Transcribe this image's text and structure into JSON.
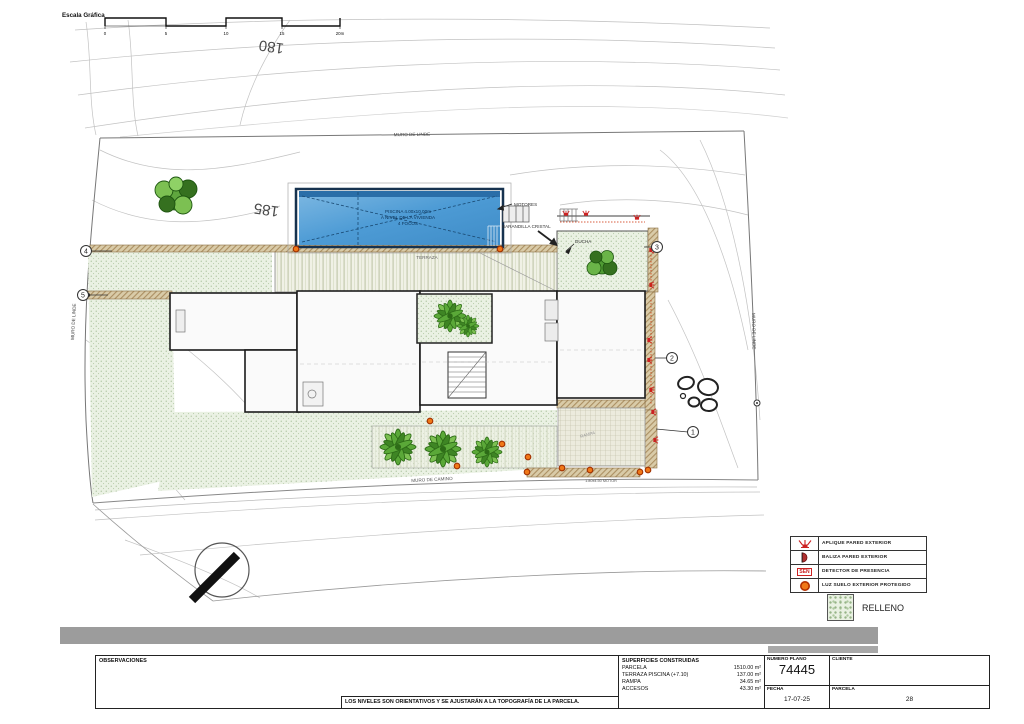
{
  "drawing": {
    "scale": {
      "title": "Escala Gráfica",
      "ticks": [
        "0",
        "5",
        "10",
        "15",
        "20m"
      ]
    },
    "contours": {
      "c180": "180",
      "c185": "185",
      "c190": "190"
    },
    "labels": {
      "muro_linde_top": "MURO DE LINDE",
      "muro_linde_left": "MURO DE LINDE",
      "muro_linde_right": "MURO DE LINDE",
      "muro_camino": "MURO DE CAMINO",
      "terraza": "TERRAZA",
      "ducha": "DUCHA",
      "motores": "MOTORES",
      "barandilla_cristal": "BARANDILLA CRISTAL",
      "rampa": "RAMPA",
      "motor_gate": "1.80x4.50 MOTOR",
      "pool_line1": "PISCINA 4.00x10.00m",
      "pool_line2": "A NIVEL DE LA VIVIENDA",
      "pool_line3": "4 FOCOS"
    },
    "markers": {
      "m1": "1",
      "m2": "2",
      "m3": "3",
      "m4": "4",
      "m5": "5"
    }
  },
  "legend": {
    "items": [
      {
        "symbol": "wall-sconce",
        "label": "APLIQUE PARED EXTERIOR"
      },
      {
        "symbol": "half-dome",
        "label": "BALIZA PARED EXTERIOR"
      },
      {
        "symbol": "sen-box",
        "sen_text": "SEN",
        "label": "DETECTOR DE PRESENCIA"
      },
      {
        "symbol": "ground-light",
        "label": "LUZ SUELO EXTERIOR PROTEGIDO"
      }
    ],
    "relleno": "RELLENO"
  },
  "titleblock": {
    "observaciones": "OBSERVACIONES",
    "note": "LOS NIVELES SON ORIENTATIVOS Y SE AJUSTARÁN A LA TOPOGRAFÍA DE LA PARCELA.",
    "superficies": {
      "header": "SUPERFICIES CONSTRUIDAS",
      "rows": [
        {
          "name": "PARCELA",
          "value": "1510.00 m²"
        },
        {
          "name": "TERRAZA PISCINA (+7.10)",
          "value": "137.00 m²"
        },
        {
          "name": "RAMPA",
          "value": "34.65 m²"
        },
        {
          "name": "ACCESOS",
          "value": "43.30 m²"
        }
      ]
    },
    "numero_plano_label": "NUMERO PLANO",
    "numero_plano": "74445",
    "fecha_label": "FECHA",
    "fecha": "17-07-25",
    "cliente_label": "CLIENTE",
    "parcela_label": "PARCELA",
    "parcela": "28"
  },
  "colors": {
    "pool_water": "#4d9bd5",
    "pool_border": "#16324f",
    "relleno_fill": "#e9f1e2",
    "wall_tan": "#d9cba8",
    "accent_red": "#cc2a00",
    "ground_light_orange": "#f07818"
  }
}
